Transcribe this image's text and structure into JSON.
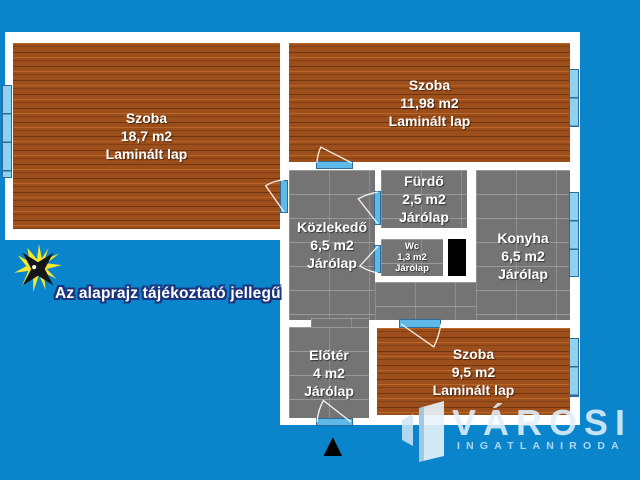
{
  "disclaimer": "Az alaprajz tájékoztató jellegű",
  "rooms": [
    {
      "name": "Szoba",
      "area": "18,7 m2",
      "floor": "Laminált lap"
    },
    {
      "name": "Szoba",
      "area": "11,98 m2",
      "floor": "Laminált lap"
    },
    {
      "name": "Közlekedő",
      "area": "6,5 m2",
      "floor": "Járólap"
    },
    {
      "name": "Fürdő",
      "area": "2,5 m2",
      "floor": "Járólap"
    },
    {
      "name": "Wc",
      "area": "1,3 m2",
      "floor": "Járólap"
    },
    {
      "name": "Konyha",
      "area": "6,5 m2",
      "floor": "Járólap"
    },
    {
      "name": "Előtér",
      "area": "4 m2",
      "floor": "Járólap"
    },
    {
      "name": "Szoba",
      "area": "9,5 m2",
      "floor": "Laminált lap"
    }
  ],
  "logo": {
    "brand": "VÁROSI",
    "tagline": "INGATLANIRODA"
  },
  "icons": {
    "north_arrow_glyph": "▲"
  },
  "colors": {
    "background": "#0a85cc",
    "wall": "#ffffff",
    "wood_floor": "#9d4f1b",
    "tile_floor": "#747474",
    "window": "#8ed2f0",
    "door": "#5fb9e6",
    "shaft": "#000000",
    "disclaimer_outline": "#1a357e",
    "logo_text": "#e0effa"
  }
}
